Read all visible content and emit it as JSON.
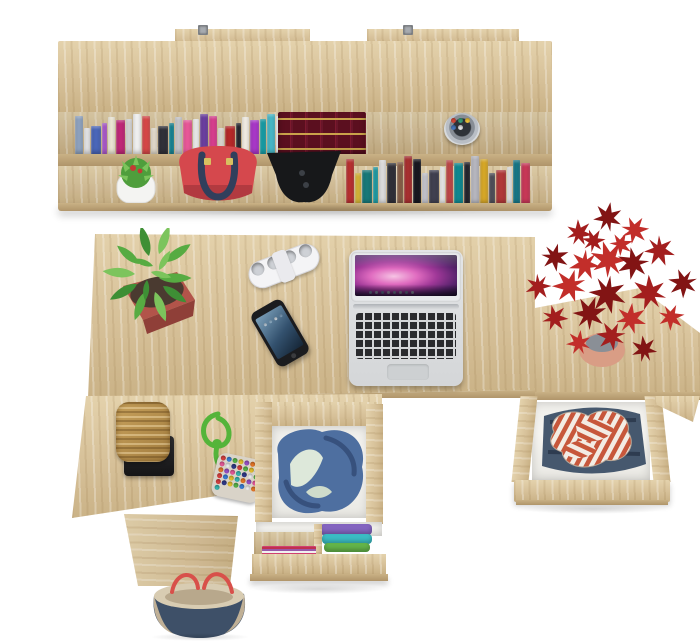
{
  "labels": {
    "scene": "top view of home office with wall shelf and desk",
    "shelf": "wall-mounted shelf with books",
    "bracket": "metal wall bracket",
    "encyclopedia": "row of dark red encyclopedias with gold trim",
    "pencil_cup": "metal pencil cup with pens",
    "cactus": "cactus in white pot",
    "handbag": "red handbag with navy handles",
    "headphones": "black headphones",
    "desk": "oak desk top",
    "plant_green": "green potted plant in red planter",
    "power_strip": "white power strip",
    "phone": "smartphone on desk",
    "laptop": "open silver laptop",
    "side_table": "side cabinet",
    "plant_red": "red maple plant in terracotta pot",
    "drawer_right": "open drawer with striped shirt and jeans",
    "left_return": "lower desk return",
    "pedestal": "desk pedestal",
    "wicker_box": "wicker box on black tray",
    "bead_pouch": "beaded pouch with green cord",
    "drawer_center": "open drawer with blue jacket",
    "drawer_lower": "open drawer with folded clothes and magazines",
    "clothes_stack": "folded clothes",
    "magazines": "magazines",
    "tote_bag": "canvas tote bag with red handles"
  },
  "palette": {
    "bg": "#ffffff",
    "wood_hi": "#e4d2ac",
    "wood_mid": "#d6c098",
    "wood_lo": "#c9b185",
    "wood_edge": "#b0956a",
    "encyclopedia": "#5b0f1f",
    "encyclopedia_gold": "#c9a24a",
    "bag_red": "#d5484d",
    "bag_red_dark": "#b23a40",
    "handle_navy": "#313f5c",
    "pot_white": "#f4f4f2",
    "cactus_green": "#4f9e3c",
    "cactus_red": "#c43a34",
    "plant_green_dark": "#3e8f35",
    "plant_green": "#57ab42",
    "plant_green_light": "#7cc45c",
    "pot_terracotta": "#b2544a",
    "pot_terracotta_dark": "#8f3f38",
    "strip_white": "#f4f4f6",
    "phone_black": "#1b1c1f",
    "phone_screen_a": "#7ba0ba",
    "phone_screen_b": "#33516e",
    "laptop_silver": "#d4d6d8",
    "laptop_key": "#2a2b2e",
    "screen_pink": "#a03898",
    "maple_dark": "#821414",
    "maple_mid": "#a31e1e",
    "maple_light": "#c22e2a",
    "maple_pot": "#d99d85",
    "denim": "#4e6fa0",
    "denim_dark": "#37517d",
    "lining": "#dde8da",
    "jeans": "#46586e",
    "jeans_dark": "#2e3c50",
    "stripe_red": "#c7573b",
    "stripe_white": "#f3ece4",
    "wicker": "#c7a15c",
    "wicker_dark": "#a27c3e",
    "rope_green": "#54b43a",
    "tote_navy": "#3e5068",
    "tote_tan": "#c0b096",
    "tote_interior": "#d8ccb2",
    "tote_red": "#d8504a",
    "mag_a": "#d04070",
    "mag_b": "#f0f0f0",
    "mag_c": "#9858a8",
    "clothes_purple": "#8465c0",
    "clothes_teal": "#3bbdc4",
    "clothes_green": "#64b54a"
  },
  "books": {
    "shelf_top": [
      "#8fa3c0",
      "#e9e9eb",
      "#4a66b8",
      "#b05ad0",
      "#f0ead8",
      "#c02878",
      "#d8d8da",
      "#f2f2f2",
      "#d84848",
      "#e8e0d0",
      "#303038",
      "#188898",
      "#c8c8cc",
      "#e85898",
      "#f0f0f0",
      "#6b3fa0",
      "#d83e8e",
      "#e0dcd4",
      "#b52828",
      "#282830",
      "#f5f0e6",
      "#a838c8",
      "#18a0a8",
      "#48b8c8",
      "#f0f0f4",
      "#104f8f"
    ],
    "shelf_bottom": [
      "#b83030",
      "#d8b838",
      "#187878",
      "#20a0a8",
      "#e0e0e0",
      "#303038",
      "#886048",
      "#a83030",
      "#181820",
      "#c8c8d0",
      "#404050",
      "#f0f0f0",
      "#c04848",
      "#0f8890",
      "#26262e",
      "#b8b8c0",
      "#d8a828",
      "#50505a",
      "#b03838",
      "#e8e8e8",
      "#187888",
      "#c83858"
    ]
  },
  "dots": {
    "pens": [
      "#d84a3a",
      "#38a07c",
      "#f0c43a",
      "#4a7ac0",
      "#e8e8e8"
    ],
    "strip_holes": [
      "#ced1d6",
      "#ced1d6",
      "#ced1d6",
      "#ced1d6"
    ],
    "dock": [
      "#9fb8d8",
      "#c8d8e8",
      "#88a8c8",
      "#d8e0ea",
      "#a0b8d0",
      "#c0ccd8",
      "#90a8c0",
      "#d0dce8"
    ],
    "phone_icons": [
      "#cfe0ee",
      "#9ec0da",
      "#e8f0f6",
      "#88aac8"
    ],
    "beads": [
      "#d94040",
      "#3a7fd9",
      "#58b54a",
      "#e8c22e",
      "#9a50c8",
      "#e87828",
      "#38b8b0",
      "#e85a9a",
      "#f0f0f0",
      "#303a8a",
      "#d94040",
      "#58b54a",
      "#e8c22e",
      "#3a7fd9",
      "#e87828",
      "#9a50c8",
      "#e85a9a",
      "#38b8b0",
      "#303a8a",
      "#f0f0f0",
      "#58b54a",
      "#d94040",
      "#3a7fd9",
      "#e8c22e",
      "#38b8b0",
      "#e87828",
      "#9a50c8",
      "#e85a9a",
      "#d94040",
      "#303a8a",
      "#e8c22e",
      "#58b54a",
      "#3a7fd9",
      "#f0f0f0",
      "#e87828",
      "#38b8b0"
    ]
  }
}
